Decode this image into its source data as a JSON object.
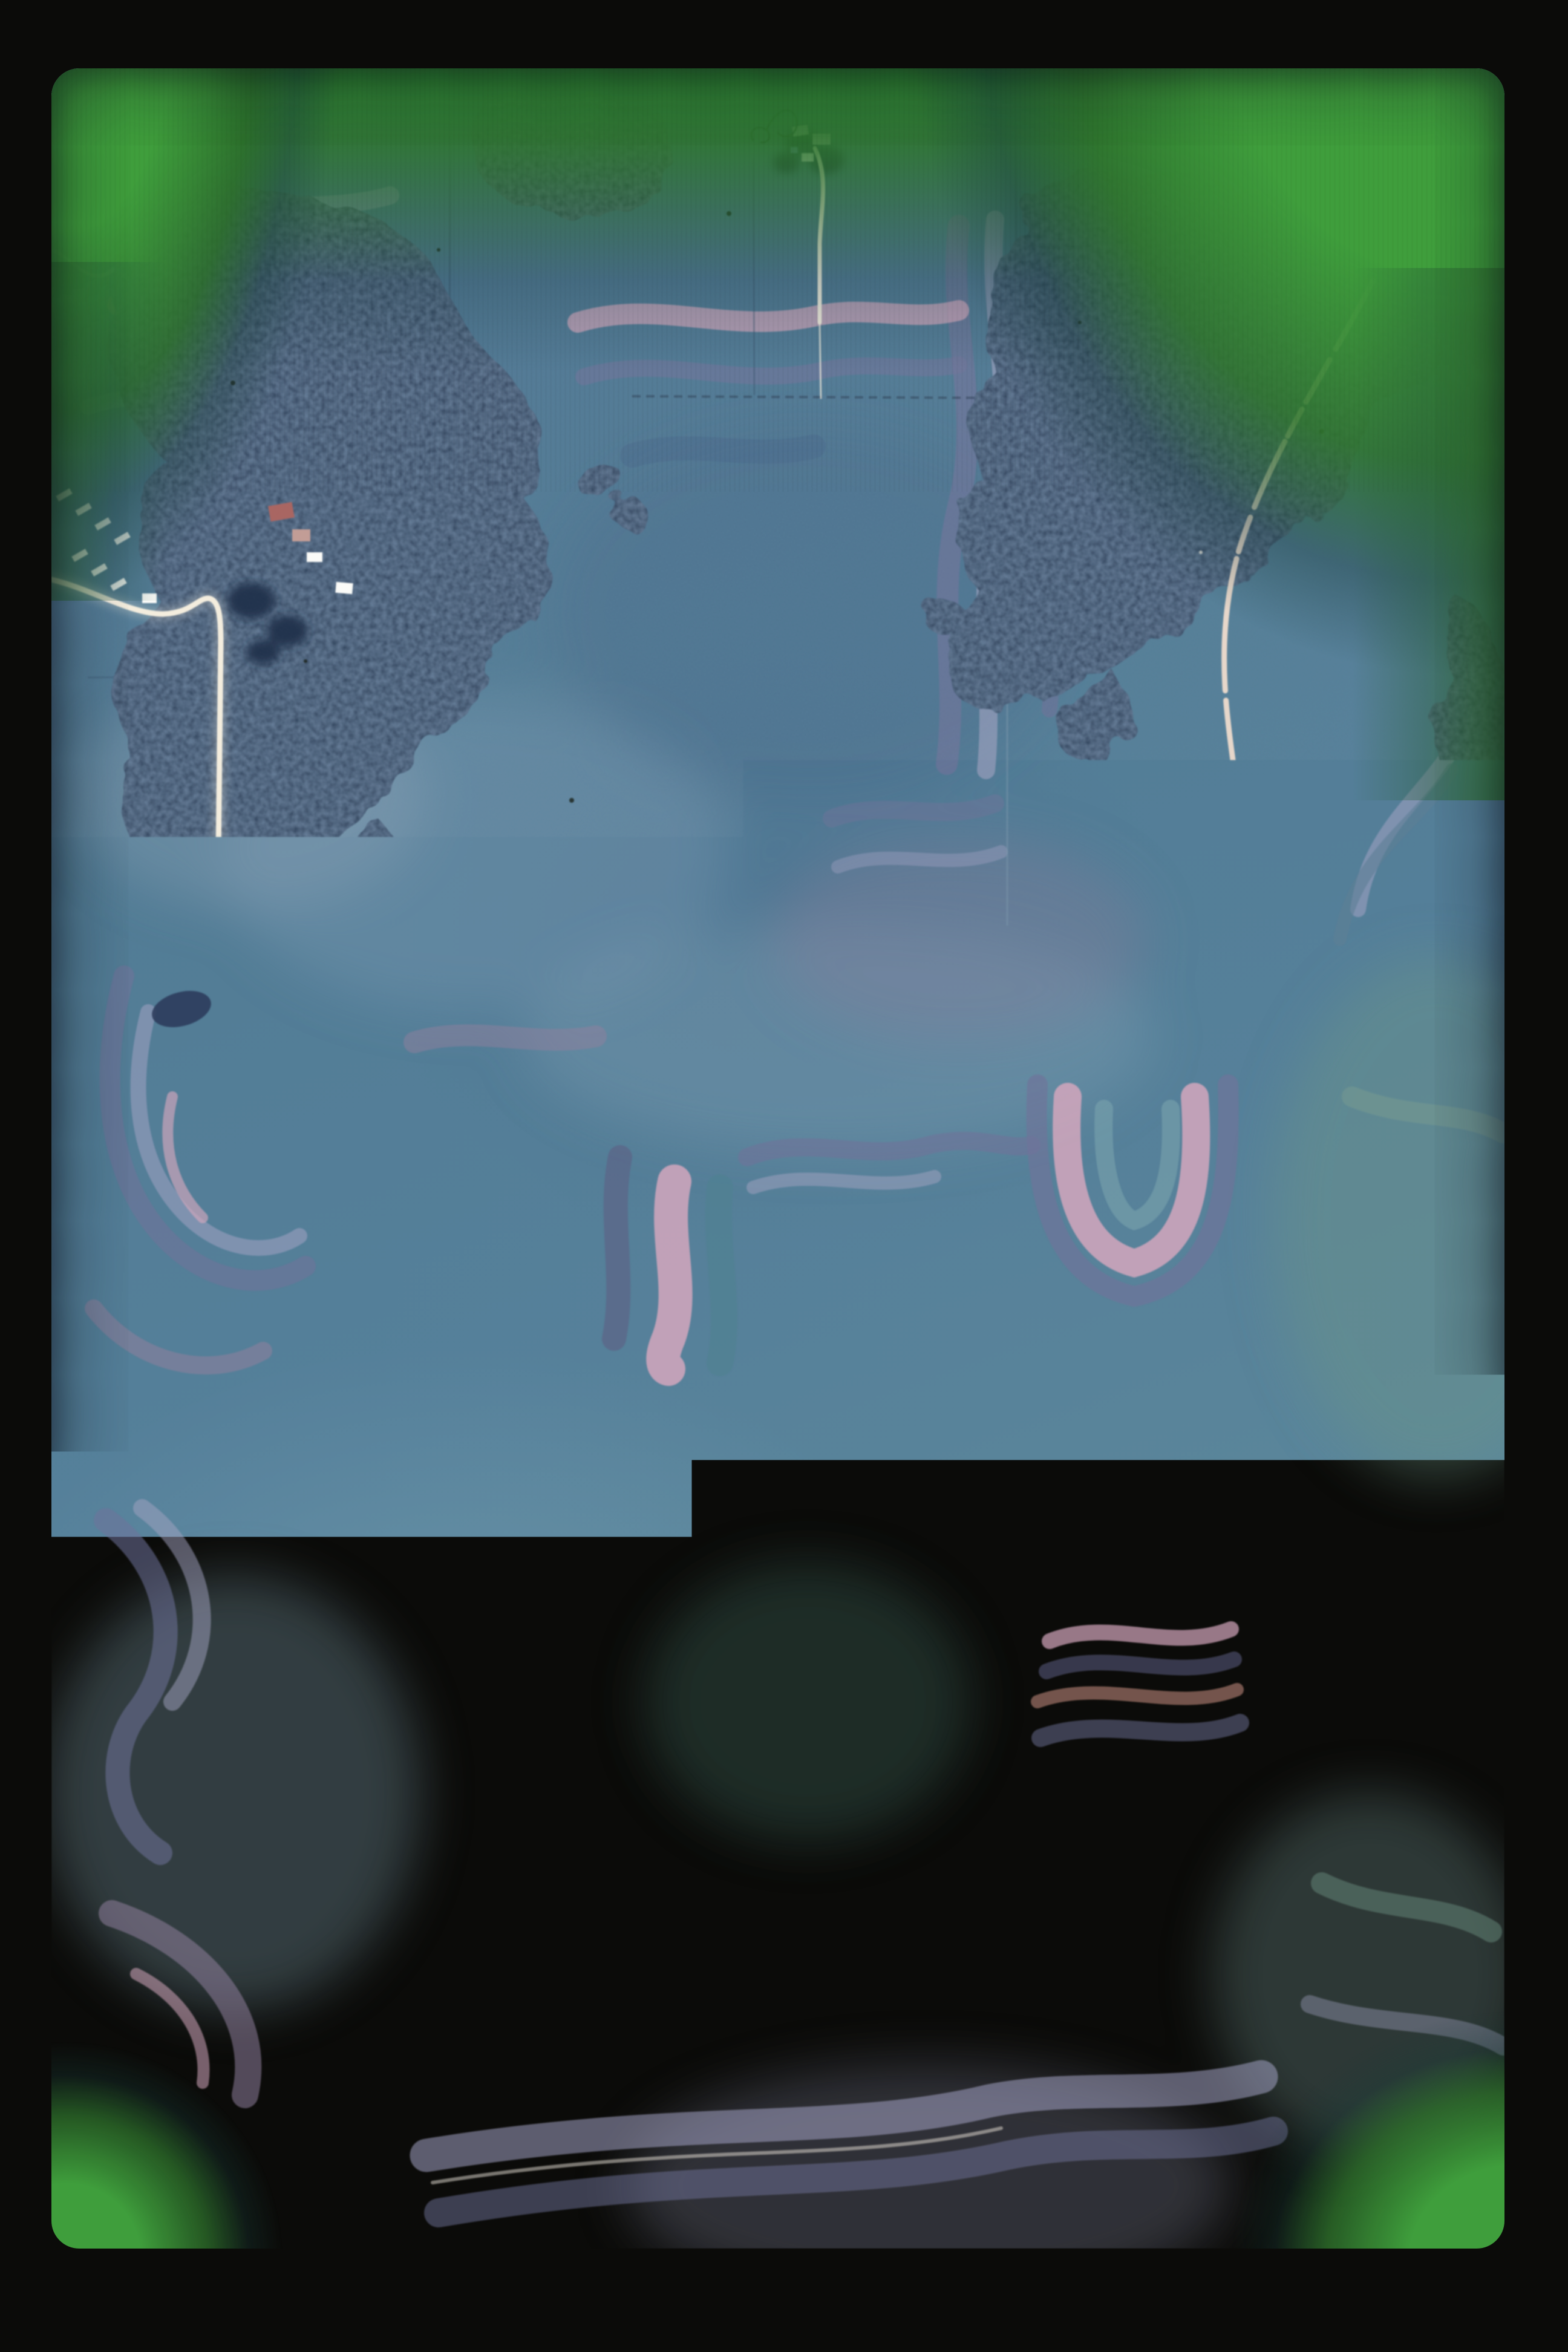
{
  "meta": {
    "title": "Scanned 35mm color slide — vertical aerial photograph of farmland",
    "description": "Aerial photo of contour strip-cropped fields in blue, slate and pink tones, with dark woodlots, bright white gravel roads, and scattered farmsteads. The slide mount forms a black border; unexposed film edges glow green at the top and the bottom corners. Dust specks and hair fibers from scanning are visible.",
    "visible_text": []
  },
  "palette": {
    "mount_black": "#0b0b09",
    "film_green_bright": "#3f9e3c",
    "film_green_mid": "#2f8631",
    "photo_base": "#527795",
    "field_teal": "#4f828f",
    "field_slate": "#70739a",
    "field_slate_dark": "#5d5f84",
    "field_lavender": "#a3a3c2",
    "field_mauve": "#8f7f9d",
    "field_pink": "#d4a7bd",
    "field_salmon": "#cc9184",
    "field_sage": "#6f9585",
    "field_bluegrey": "#46678a",
    "forest_dark": "#263a55",
    "forest_canopy": "#3a5878",
    "road_white": "#f6efdf",
    "road_tan": "#e9d8ca",
    "building_white": "#fdfdfa",
    "roof_blue": "#6d86c8",
    "roof_red": "#a8625e",
    "tree_shadow": "#1d2f49",
    "pond_dark": "#2c3c5c",
    "dust_dark": "#131a11",
    "dust_light": "#e8e4da",
    "hair_dark": "#1a2428"
  },
  "scene": {
    "film_frame": "rounded-corner 35mm frame inside black mount",
    "roads": [
      {
        "id": "main-east-west",
        "note": "bright white road across center"
      },
      {
        "id": "right-section-road",
        "note": "long vertical road on right, curving to bottom-right corner"
      },
      {
        "id": "diagonal-highway",
        "note": "road descending through upper-right woods, broken by tree shadows"
      },
      {
        "id": "left-wiggle-road",
        "note": "enters left edge, bends south then southwest off the frame"
      },
      {
        "id": "bottom-woods-road",
        "note": "east-west road through bottom forest"
      },
      {
        "id": "farm-lanes",
        "note": "short driveways at several farmsteads"
      }
    ],
    "farmsteads": [
      {
        "id": "top-center-farm"
      },
      {
        "id": "top-left-small-farm"
      },
      {
        "id": "left-poultry-farm",
        "note": "rows of small white sheds, red-roofed buildings"
      },
      {
        "id": "mid-left-farm"
      },
      {
        "id": "center-farm-north"
      },
      {
        "id": "center-farm-east"
      },
      {
        "id": "center-farm-south-lane"
      },
      {
        "id": "junction-farm-east"
      },
      {
        "id": "mid-right-road-farm"
      },
      {
        "id": "bottom-center-farm"
      },
      {
        "id": "bottom-right-farm"
      },
      {
        "id": "right-edge-buildings"
      }
    ],
    "forests": [
      {
        "id": "upper-left-woodlot"
      },
      {
        "id": "top-strip-woodlot"
      },
      {
        "id": "upper-right-woodlot"
      },
      {
        "id": "central-woodlot",
        "note": "largest, with interior clearings"
      },
      {
        "id": "bottom-road-woodlot"
      },
      {
        "id": "right-mid-clumps"
      },
      {
        "id": "right-edge-patch"
      }
    ],
    "fields": "wavy alternating contour strips: teal, slate-purple, lavender, mauve, pink and salmon bands over steel-blue base",
    "artifacts": [
      {
        "id": "hair-fiber-top-center"
      },
      {
        "id": "hair-arc-center"
      },
      {
        "id": "hair-bottom-left-curl"
      },
      {
        "id": "scratch-left"
      },
      {
        "id": "dust-specks"
      }
    ]
  }
}
